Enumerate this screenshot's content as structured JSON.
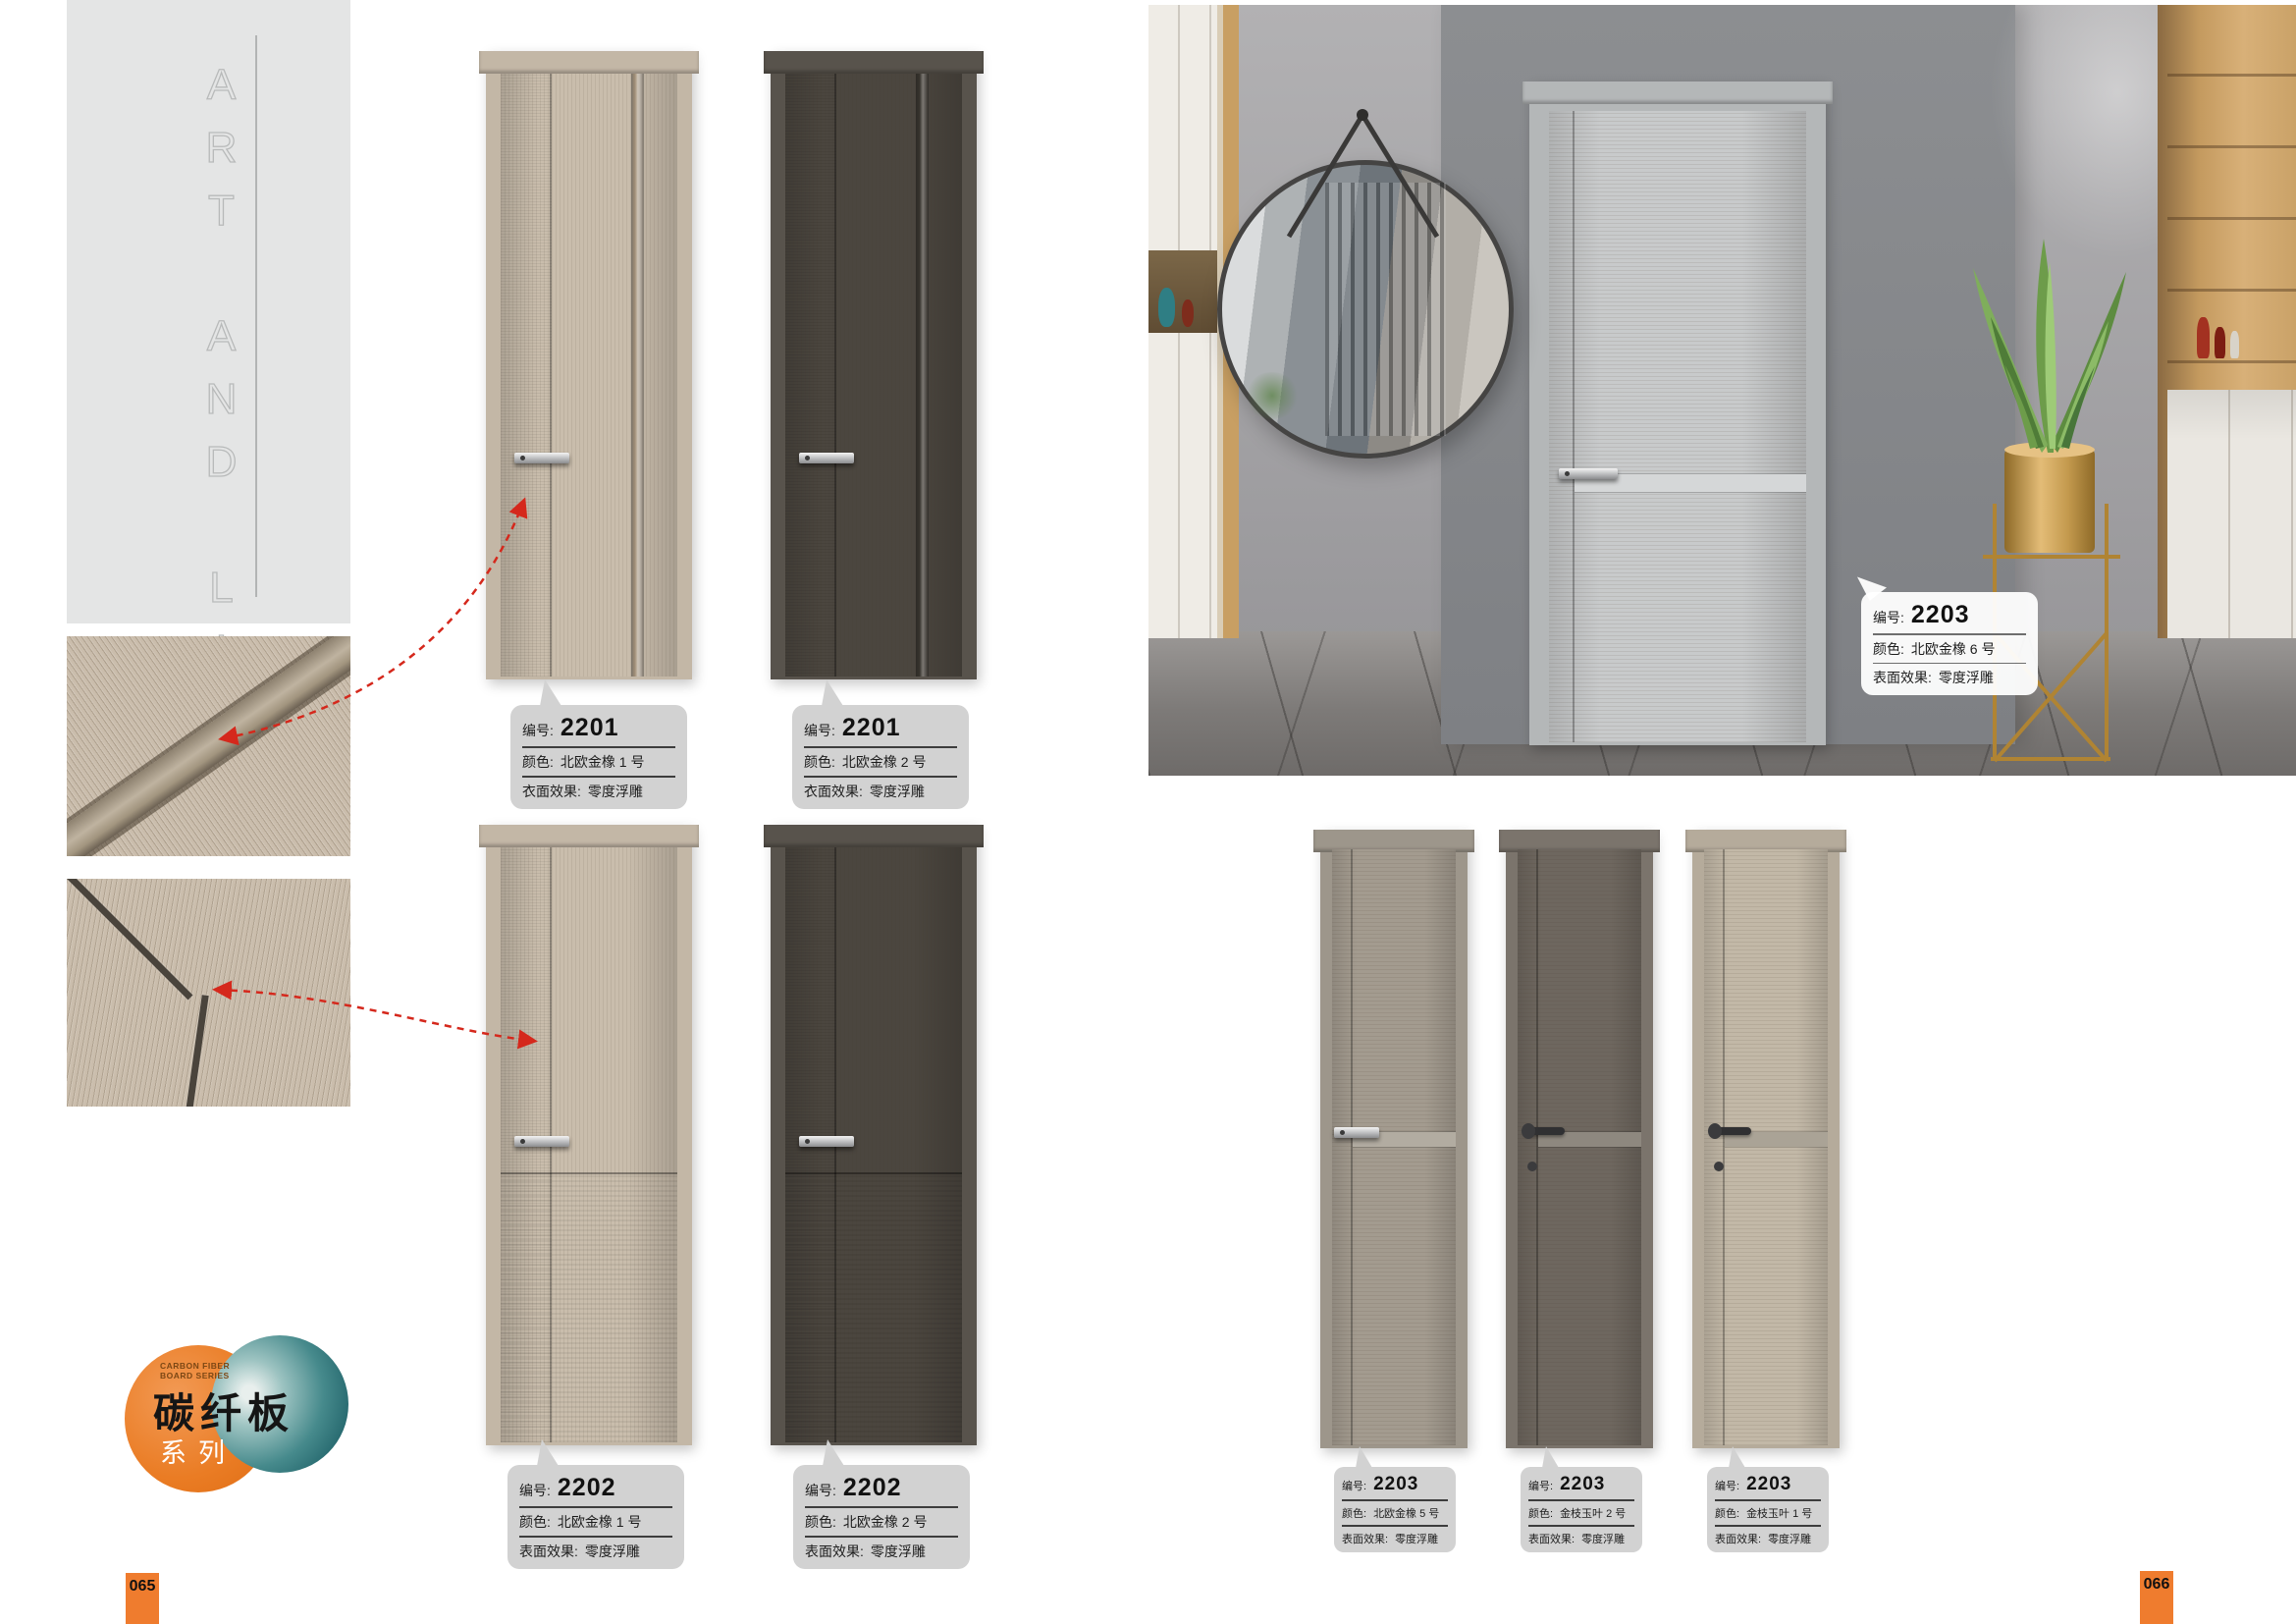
{
  "brand": {
    "vertical_text": "ART AND LIFE"
  },
  "series_logo": {
    "tagline_line1": "CARBON FIBER",
    "tagline_line2": "BOARD SERIES",
    "title": "碳纤板",
    "subtitle": "系列"
  },
  "captions": {
    "code": "编号:",
    "color": "颜色:",
    "effect_surface": "表面效果:",
    "effect_cloth": "衣面效果:"
  },
  "products": [
    {
      "code": "2201",
      "color": "北欧金橡 1 号",
      "effect": "零度浮雕"
    },
    {
      "code": "2201",
      "color": "北欧金橡 2 号",
      "effect": "零度浮雕"
    },
    {
      "code": "2202",
      "color": "北欧金橡 1 号",
      "effect": "零度浮雕"
    },
    {
      "code": "2202",
      "color": "北欧金橡 2 号",
      "effect": "零度浮雕"
    },
    {
      "code": "2203",
      "color": "北欧金橡 5 号",
      "effect": "零度浮雕"
    },
    {
      "code": "2203",
      "color": "金枝玉叶 2 号",
      "effect": "零度浮雕"
    },
    {
      "code": "2203",
      "color": "金枝玉叶 1 号",
      "effect": "零度浮雕"
    },
    {
      "code": "2203",
      "color": "北欧金橡 6 号",
      "effect": "零度浮雕"
    }
  ],
  "page_numbers": {
    "left": "065",
    "right": "066"
  },
  "colors": {
    "accent_orange": "#ef7c2e",
    "bubble_gray": "#d2d2d2",
    "arrow_red": "#d5281c",
    "logo_orange": "#ea7c24",
    "logo_teal": "#2a6e74"
  }
}
